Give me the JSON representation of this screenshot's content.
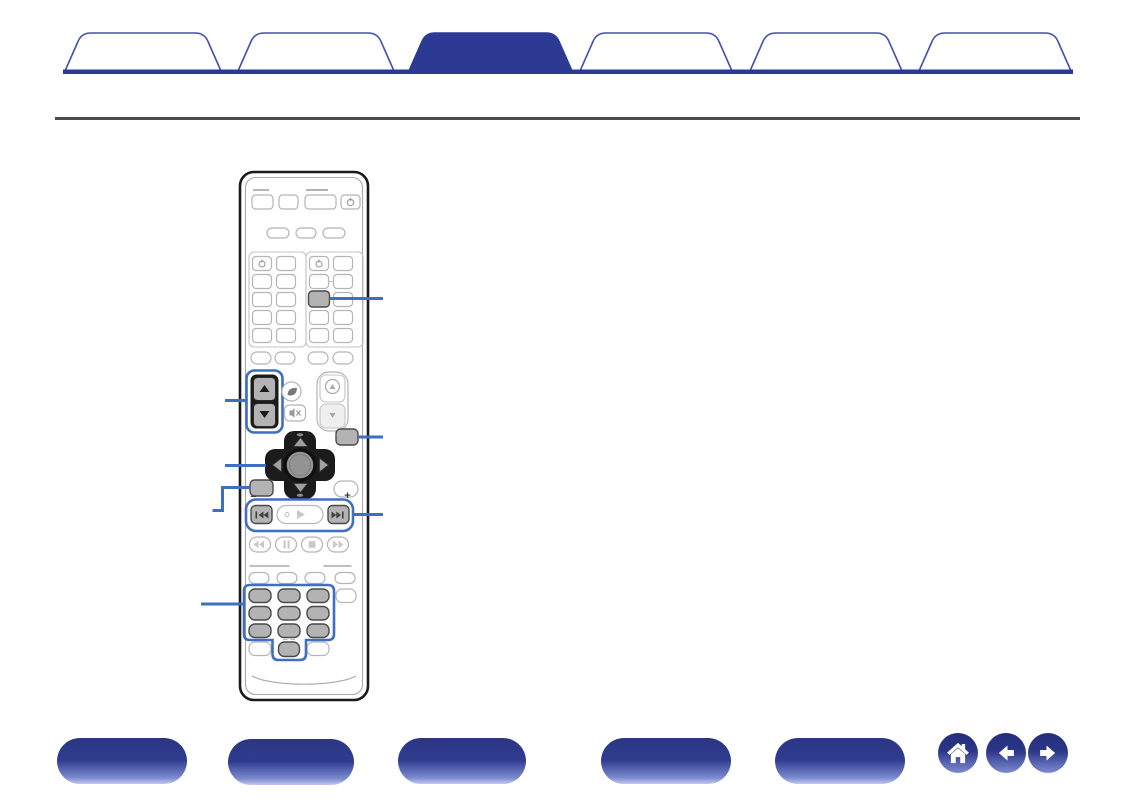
{
  "window": {
    "width": 1135,
    "height": 800,
    "background": "#ffffff"
  },
  "colors": {
    "deep_blue": "#2d3a94",
    "tab_outline": "#4350ae",
    "callout_blue": "#3e6fc1",
    "rule_gray": "#4b4b4d",
    "gray_button_fill": "#b3b3b3",
    "gray_button_border": "#4a4a4a",
    "light_button_border": "#b5b5b5",
    "pad_black": "#1b1b1b",
    "nav_gradient_top": "#2c3683",
    "nav_gradient_bottom": "#c2c9ef"
  },
  "header": {
    "tabs": [
      {
        "label": "",
        "active": false
      },
      {
        "label": "",
        "active": false
      },
      {
        "label": "",
        "active": true
      },
      {
        "label": "",
        "active": false
      },
      {
        "label": "",
        "active": false
      },
      {
        "label": "",
        "active": false
      }
    ],
    "active_tab_index": 2
  },
  "remote": {
    "description": "remote-control-illustration",
    "skip_minus": "−",
    "skip_plus": "+",
    "highlighted_groups": [
      "channel-updown-rocker",
      "source-grid-button",
      "setup-button",
      "left-function-button",
      "skip-buttons-row",
      "number-keypad"
    ],
    "callouts": {
      "left_count": 4,
      "right_count": 3
    },
    "icon_names": [
      "power-icon",
      "eco-leaf-icon",
      "mute-speaker-icon",
      "volume-up-icon",
      "volume-down-icon",
      "cursor-up-icon",
      "cursor-down-icon",
      "cursor-left-icon",
      "cursor-right-icon",
      "skip-back-icon",
      "play-icon",
      "skip-forward-icon",
      "rewind-icon",
      "pause-icon",
      "stop-icon",
      "fast-forward-icon"
    ]
  },
  "footer": {
    "nav_buttons": [
      {
        "label": ""
      },
      {
        "label": ""
      },
      {
        "label": ""
      },
      {
        "label": ""
      },
      {
        "label": ""
      }
    ],
    "icons": [
      {
        "name": "home-icon"
      },
      {
        "name": "back-icon"
      },
      {
        "name": "forward-icon"
      }
    ]
  }
}
